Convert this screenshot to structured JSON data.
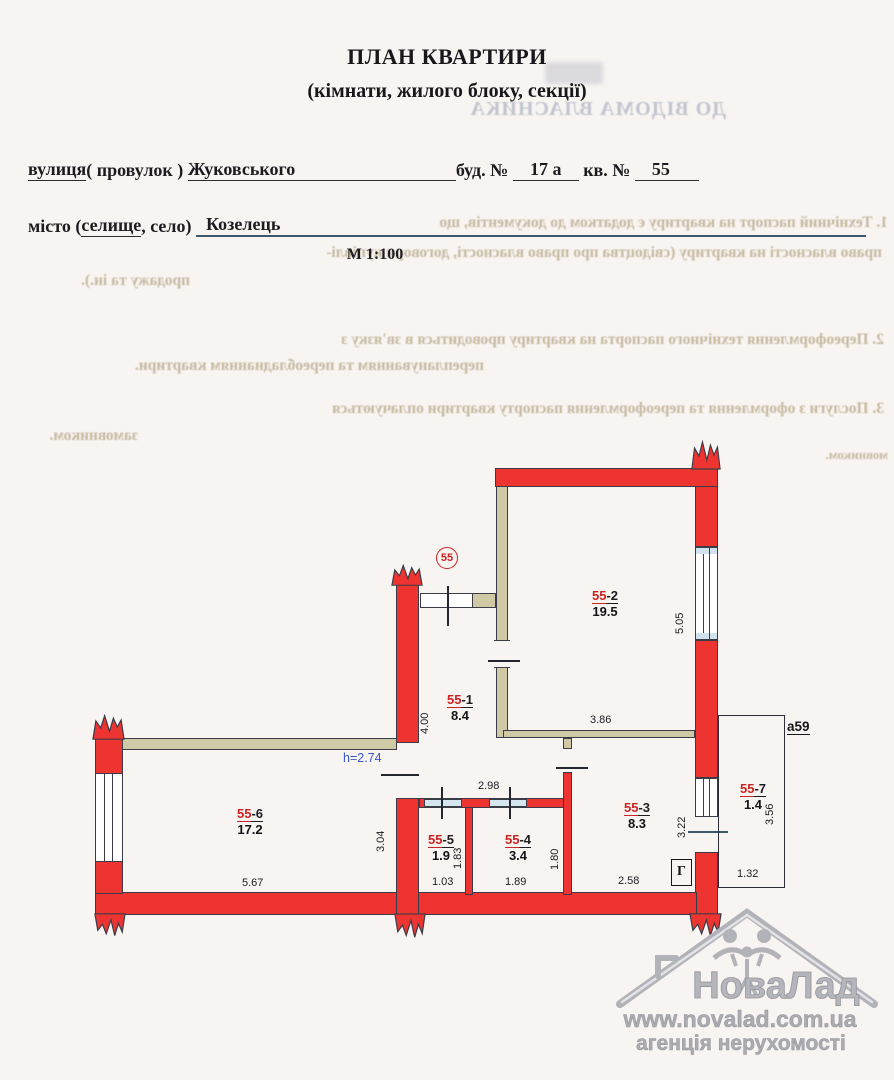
{
  "document": {
    "title": "ПЛАН КВАРТИРИ",
    "subtitle": "(кімнати, жилого блоку, секції)",
    "street_label_1": "вулиця",
    "street_label_2": "( провулок ) ",
    "street_value": "Жуковського",
    "building_label": "буд. № ",
    "building_value": "17 а",
    "apartment_label": " кв. № ",
    "apartment_value": "55",
    "city_label_1": "місто (",
    "city_label_2": "селище",
    "city_label_3": ", село) ",
    "city_value": "Козелець",
    "scale": "М 1:100"
  },
  "bleedthrough": {
    "header": "ДО ВІДОМА ВЛАСНИКА",
    "p1_line1": "1. Технічний паспорт на квартиру є додатком до документів, що",
    "p1_line2": "право власності на квартиру (свідоцтва про право власності, договори купівлі-",
    "p1_line3": "продажу та ін.).",
    "p2_line1": "2. Переоформлення технічного паспорта на квартиру проводиться в зв'язку з",
    "p2_line2": "переплануванням та переобладнанням квартири.",
    "p3_line1": "3. Послуги з оформлення та переоформлення паспорту квартири оплачуються",
    "p3_line2": "замовником.",
    "p3_fragment": "мовником."
  },
  "plan": {
    "apartment_badge": "55",
    "height_note": "h=2.74",
    "balcony_label": "а59",
    "gas_marker": "Г",
    "rooms": [
      {
        "num": "55",
        "suffix": "-1",
        "area": "8.4"
      },
      {
        "num": "55",
        "suffix": "-2",
        "area": "19.5"
      },
      {
        "num": "55",
        "suffix": "-3",
        "area": "8.3"
      },
      {
        "num": "55",
        "suffix": "-4",
        "area": "3.4"
      },
      {
        "num": "55",
        "suffix": "-5",
        "area": "1.9"
      },
      {
        "num": "55",
        "suffix": "-6",
        "area": "17.2"
      },
      {
        "num": "55",
        "suffix": "-7",
        "area": "1.4"
      }
    ],
    "dims": {
      "room2_height": "5.05",
      "hall_height": "4.00",
      "room3_top_width": "3.86",
      "hall_width": "2.98",
      "room6_height": "3.04",
      "room6_width": "5.67",
      "room5_height": "1.83",
      "room5_width": "1.03",
      "room4_height": "1.80",
      "room4_width": "1.89",
      "room3_bottom_width": "2.58",
      "room3_height": "3.22",
      "balcony_height": "3.56",
      "balcony_width": "1.32"
    },
    "colors": {
      "wall": "#ee3430",
      "partition": "#cfc9a5",
      "outline": "#3a3d48",
      "sill": "#cfe2ee",
      "room_code": "#cc2222",
      "height_note": "#3a56c8"
    }
  },
  "watermark": {
    "name": "НоваЛад",
    "url": "www.novalad.com.ua",
    "tagline": "агенція нерухомості"
  }
}
